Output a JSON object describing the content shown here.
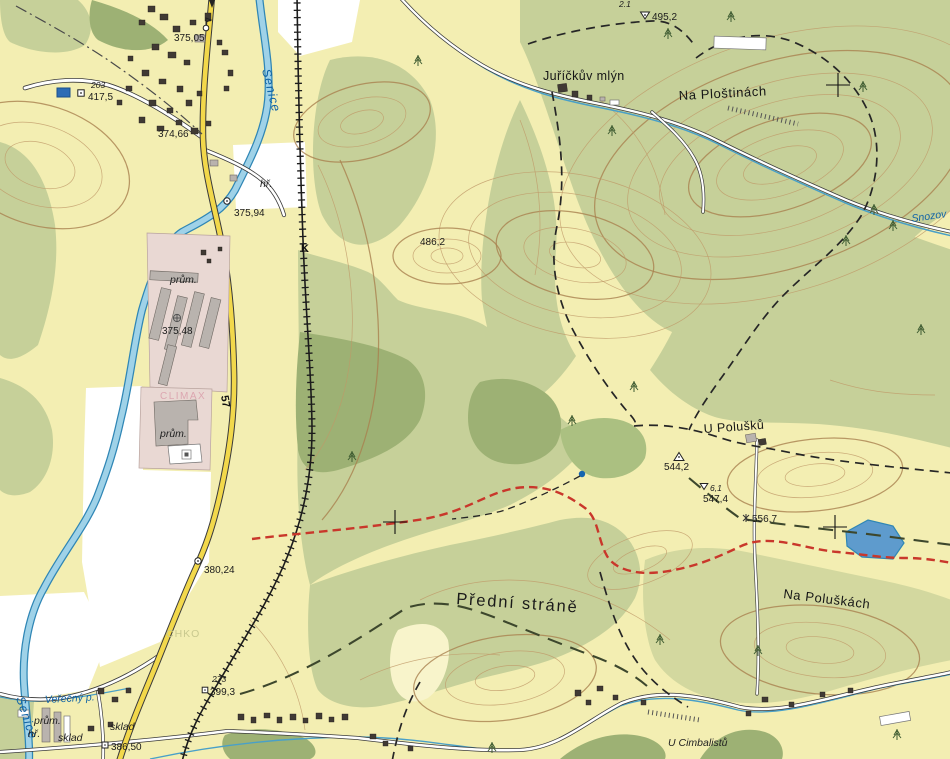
{
  "colors": {
    "field": "#f3eeb2",
    "forest": "#c6d099",
    "forest_dark": "#9db174",
    "grass_slope": "#d3d89f",
    "meadow_white": "#ffffff",
    "industrial_pink": "#e9d8d3",
    "water": "#2f86b5",
    "water_fill": "#9fd2e8",
    "road_yellow": "#f2d84b",
    "trail_red": "#c9372b",
    "contour": "#bf9868"
  },
  "place_labels": {
    "na_plostinach": "Na Ploštinách",
    "jurickuv_mlyn": "Juříčkův mlýn",
    "u_polusku": "U Polušků",
    "predni_strane": "Přední stráně",
    "na_poluskach": "Na Poluškách",
    "u_cimbalistu": "U Cimbalistů",
    "chko": "CHKO",
    "climax": "CLIMAX"
  },
  "water_labels": {
    "senice_upper": "Senice",
    "senice_lower": "Senice",
    "verecny_potok": "Veřečný p.",
    "snozov": "Snozov"
  },
  "land_use_labels": {
    "prum_1": "prům.",
    "prum_2": "prům.",
    "prum_3": "prům.",
    "hriste_1": "hř.",
    "hriste_2": "hř.",
    "sklad_1": "sklad",
    "sklad_2": "sklad"
  },
  "road_labels": {
    "route_57": "57",
    "railway_k": "K"
  },
  "elevation_points": {
    "p375_05": "375,05",
    "p203": "203",
    "p417_5": "417,5",
    "p374_66": "374,66",
    "p375_94": "375,94",
    "p375_48": "375,48",
    "p380_24": "380,24",
    "p386_50": "386,50",
    "p273": "273",
    "p399_3": "399,3",
    "p2_1": "2.1",
    "p495_2": "495,2",
    "p486_2": "486,2",
    "p544_2": "544,2",
    "p6_1": "6,1",
    "p547_4": "547,4",
    "p556_7": "556,7"
  }
}
